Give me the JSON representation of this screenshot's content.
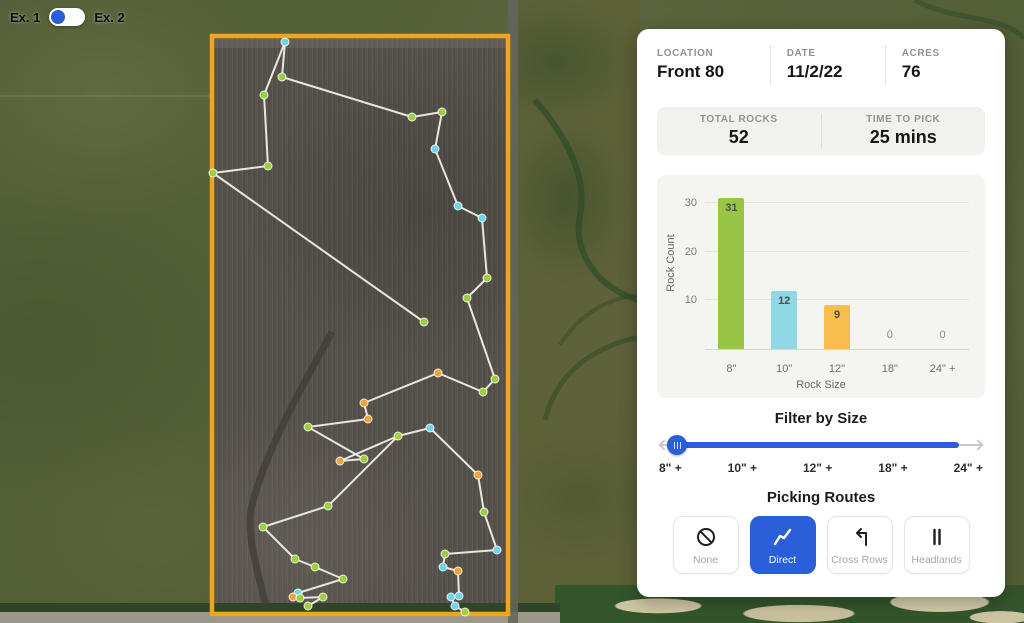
{
  "view_toggle": {
    "left_label": "Ex. 1",
    "right_label": "Ex. 2",
    "selected": "left"
  },
  "accent_color": "#2a5fd9",
  "panel": {
    "header": {
      "fields": [
        {
          "label": "LOCATION",
          "value": "Front 80"
        },
        {
          "label": "DATE",
          "value": "11/2/22"
        },
        {
          "label": "ACRES",
          "value": "76"
        }
      ]
    },
    "totals": {
      "fields": [
        {
          "label": "TOTAL ROCKS",
          "value": "52"
        },
        {
          "label": "TIME TO PICK",
          "value": "25 mins"
        }
      ]
    },
    "filter": {
      "title": "Filter by Size",
      "tick_labels": [
        "8\" +",
        "10\" +",
        "12\" +",
        "18\" +",
        "24\" +"
      ],
      "selected_index": 0
    },
    "routes": {
      "title": "Picking Routes",
      "options": [
        {
          "label": "None",
          "icon": "no-symbol-icon",
          "selected": false
        },
        {
          "label": "Direct",
          "icon": "zigzag-route-icon",
          "selected": true
        },
        {
          "label": "Cross Rows",
          "icon": "turn-left-arrow-icon",
          "selected": false
        },
        {
          "label": "Headlands",
          "icon": "parallel-bars-icon",
          "selected": false
        }
      ]
    }
  },
  "chart_data": {
    "type": "bar",
    "title": "",
    "xlabel": "Rock Size",
    "ylabel": "Rock Count",
    "categories": [
      "8\"",
      "10\"",
      "12\"",
      "18\"",
      "24\" +"
    ],
    "values": [
      31,
      12,
      9,
      0,
      0
    ],
    "bar_colors": [
      "#98c545",
      "#90d8e4",
      "#f7bd4e",
      "",
      ""
    ],
    "ylim": [
      0,
      32
    ],
    "yticks": [
      10,
      20,
      30
    ],
    "grid": true,
    "legend": false
  },
  "map": {
    "boundary": {
      "x": 212,
      "y": 36,
      "width": 296,
      "height": 578,
      "color": "#f0a41f"
    },
    "route_line_color": "#e9e6de",
    "dot_colors": {
      "8": "#9cce3f",
      "10": "#6fd3ea",
      "12": "#f0a23b"
    },
    "routes": [
      [
        [
          264,
          95
        ],
        [
          285,
          42
        ],
        [
          282,
          77
        ],
        [
          412,
          117
        ],
        [
          442,
          112
        ],
        [
          435,
          149
        ],
        [
          458,
          206
        ],
        [
          482,
          218
        ],
        [
          487,
          278
        ],
        [
          467,
          298
        ],
        [
          495,
          379
        ],
        [
          483,
          392
        ],
        [
          438,
          373
        ],
        [
          364,
          403
        ],
        [
          368,
          419
        ],
        [
          308,
          427
        ],
        [
          364,
          459
        ],
        [
          340,
          461
        ],
        [
          398,
          436
        ],
        [
          430,
          428
        ],
        [
          478,
          475
        ],
        [
          484,
          512
        ],
        [
          497,
          550
        ],
        [
          445,
          554
        ],
        [
          443,
          567
        ],
        [
          458,
          571
        ],
        [
          459,
          596
        ],
        [
          451,
          597
        ],
        [
          455,
          606
        ],
        [
          465,
          612
        ]
      ],
      [
        [
          264,
          95
        ],
        [
          268,
          166
        ],
        [
          213,
          173
        ],
        [
          424,
          322
        ]
      ],
      [
        [
          398,
          436
        ],
        [
          328,
          506
        ],
        [
          263,
          527
        ],
        [
          295,
          559
        ],
        [
          315,
          567
        ],
        [
          343,
          579
        ],
        [
          298,
          593
        ],
        [
          293,
          597
        ],
        [
          300,
          598
        ],
        [
          323,
          597
        ],
        [
          308,
          606
        ]
      ]
    ],
    "dots": [
      [
        285,
        42,
        "10"
      ],
      [
        282,
        77,
        "8"
      ],
      [
        264,
        95,
        "8"
      ],
      [
        412,
        117,
        "8"
      ],
      [
        442,
        112,
        "8"
      ],
      [
        435,
        149,
        "10"
      ],
      [
        458,
        206,
        "10"
      ],
      [
        482,
        218,
        "10"
      ],
      [
        487,
        278,
        "8"
      ],
      [
        467,
        298,
        "8"
      ],
      [
        268,
        166,
        "8"
      ],
      [
        213,
        173,
        "8"
      ],
      [
        424,
        322,
        "8"
      ],
      [
        438,
        373,
        "12"
      ],
      [
        495,
        379,
        "8"
      ],
      [
        483,
        392,
        "8"
      ],
      [
        364,
        403,
        "12"
      ],
      [
        368,
        419,
        "12"
      ],
      [
        308,
        427,
        "8"
      ],
      [
        398,
        436,
        "8"
      ],
      [
        430,
        428,
        "10"
      ],
      [
        340,
        461,
        "12"
      ],
      [
        364,
        459,
        "8"
      ],
      [
        478,
        475,
        "12"
      ],
      [
        484,
        512,
        "8"
      ],
      [
        328,
        506,
        "8"
      ],
      [
        263,
        527,
        "8"
      ],
      [
        295,
        559,
        "8"
      ],
      [
        315,
        567,
        "8"
      ],
      [
        343,
        579,
        "8"
      ],
      [
        298,
        593,
        "10"
      ],
      [
        293,
        597,
        "12"
      ],
      [
        300,
        598,
        "8"
      ],
      [
        323,
        597,
        "8"
      ],
      [
        308,
        606,
        "8"
      ],
      [
        445,
        554,
        "8"
      ],
      [
        497,
        550,
        "10"
      ],
      [
        443,
        567,
        "10"
      ],
      [
        458,
        571,
        "12"
      ],
      [
        451,
        597,
        "10"
      ],
      [
        459,
        596,
        "10"
      ],
      [
        455,
        606,
        "10"
      ],
      [
        465,
        612,
        "8"
      ]
    ]
  }
}
